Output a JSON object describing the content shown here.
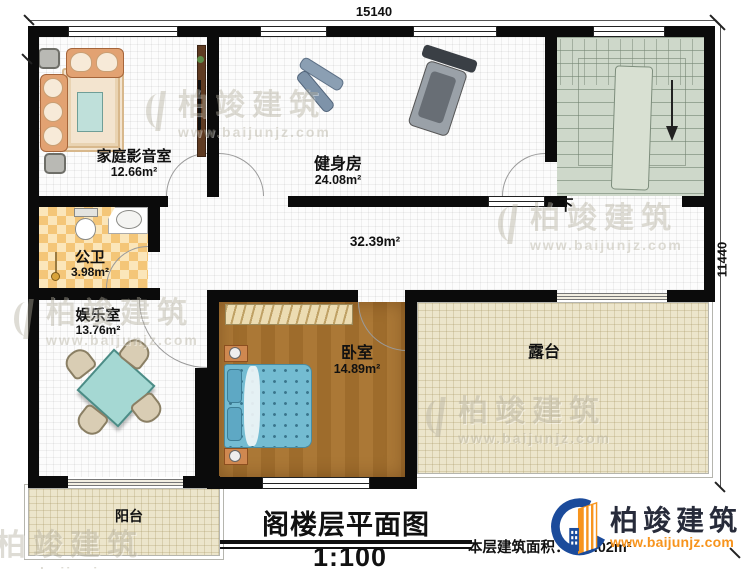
{
  "dimensions": {
    "top": "15140",
    "right": "11440"
  },
  "rooms": {
    "home_theater": {
      "name": "家庭影音室",
      "area": "12.66m²"
    },
    "gym": {
      "name": "健身房",
      "area": "24.08m²"
    },
    "bathroom": {
      "name": "公卫",
      "area": "3.98m²"
    },
    "recreation": {
      "name": "娱乐室",
      "area": "13.76m²"
    },
    "hall": {
      "area": "32.39m²"
    },
    "bedroom": {
      "name": "卧室",
      "area": "14.89m²"
    },
    "terrace": {
      "name": "露台"
    },
    "balcony": {
      "name": "阳台"
    }
  },
  "stairs": {
    "down": "下"
  },
  "title_block": {
    "title": "阁楼层平面图",
    "scale": "1:100",
    "area_note": "本层建筑面积：124.02m²"
  },
  "brand": {
    "name": "柏竣建筑",
    "site": "www.baijunjz.com",
    "blue": "#1b4b9b",
    "orange": "#f7941d"
  },
  "watermark": {
    "name": "柏竣建筑",
    "site": "www.baijunjz.com"
  }
}
